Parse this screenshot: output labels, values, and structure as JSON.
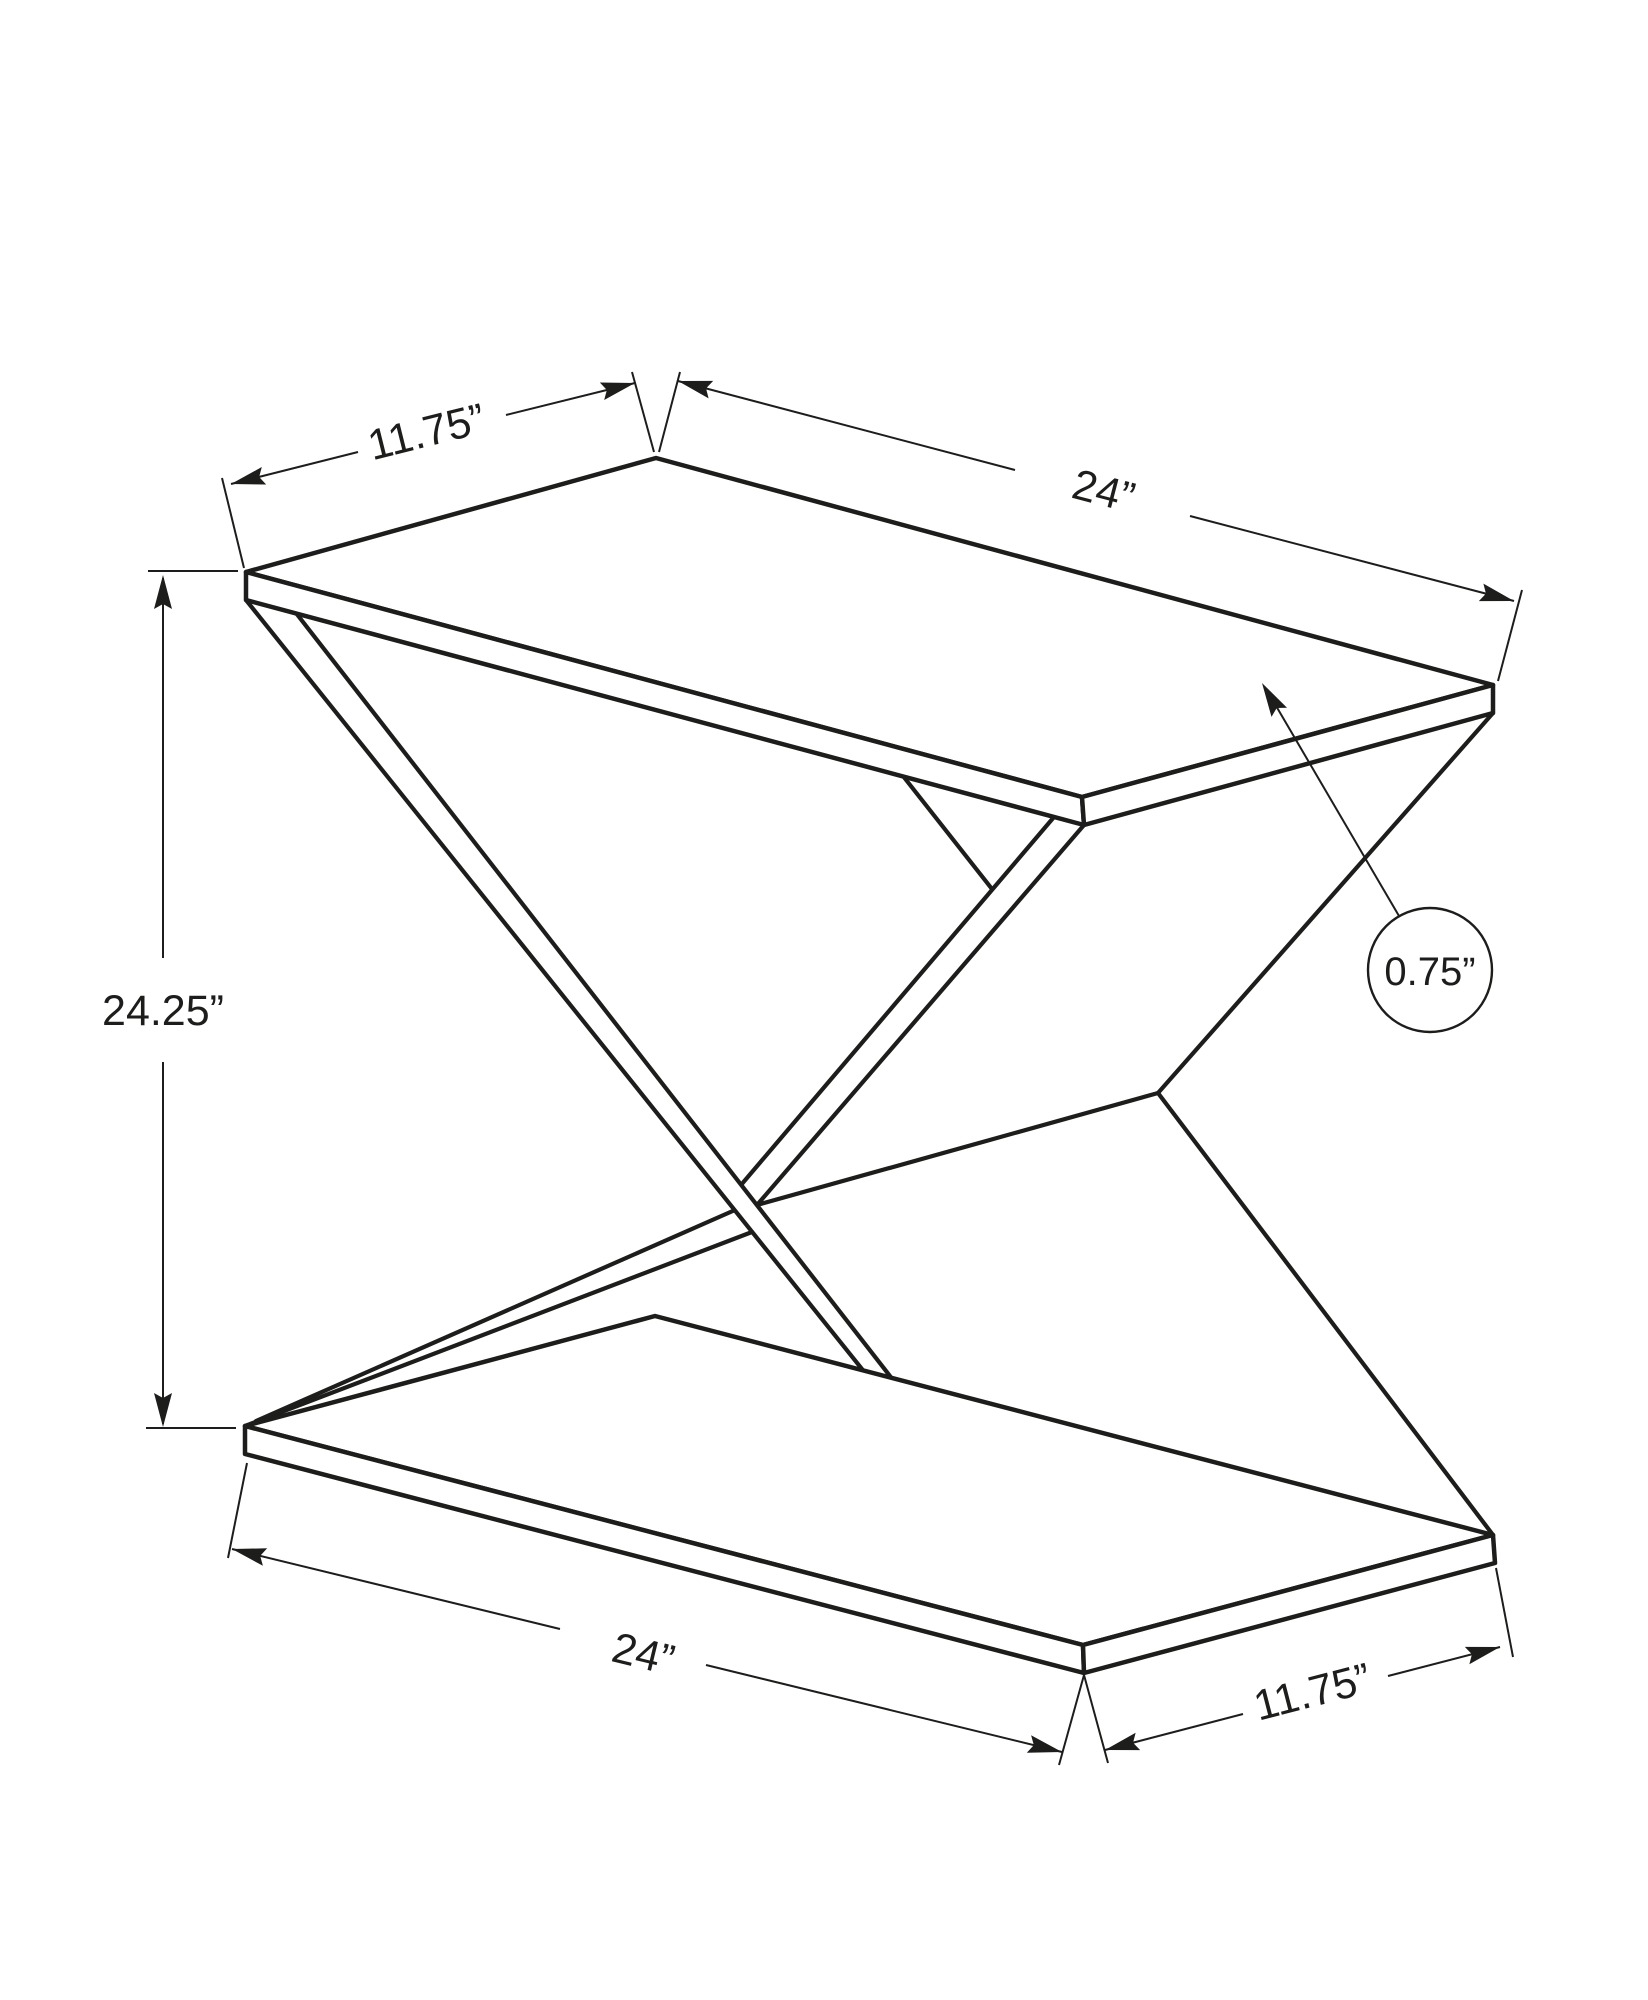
{
  "diagram": {
    "description": "isometric line drawing of x-frame accent table with dimensions",
    "dimensions": {
      "top_depth_label": "11.75”",
      "top_width_label": "24”",
      "height_label": "24.25”",
      "top_thickness_label": "0.75”",
      "bottom_width_label": "24”",
      "bottom_depth_label": "11.75”"
    },
    "colors": {
      "ink": "#1d1d1b",
      "background": "#ffffff"
    }
  }
}
